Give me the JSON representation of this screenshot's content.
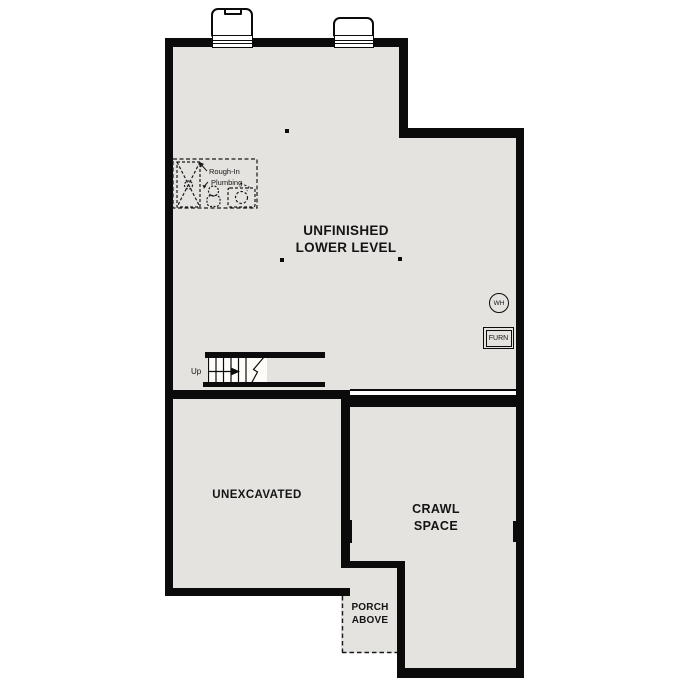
{
  "drawing": {
    "type": "basement-floor-plan",
    "colors": {
      "wall": "#0b0b0b",
      "floor_fill": "#e5e3e0",
      "background": "#ffffff"
    },
    "rooms": {
      "unfinished": {
        "line1": "UNFINISHED",
        "line2": "LOWER LEVEL"
      },
      "unexcavated": {
        "label": "UNEXCAVATED"
      },
      "crawl": {
        "line1": "CRAWL",
        "line2": "SPACE"
      },
      "porch": {
        "line1": "PORCH",
        "line2": "ABOVE"
      }
    },
    "annotations": {
      "plumbing_line1": "Rough-In",
      "plumbing_line2": "Plumbing",
      "stairs_up": "Up",
      "water_heater": "WH",
      "furnace": "FURN"
    }
  }
}
